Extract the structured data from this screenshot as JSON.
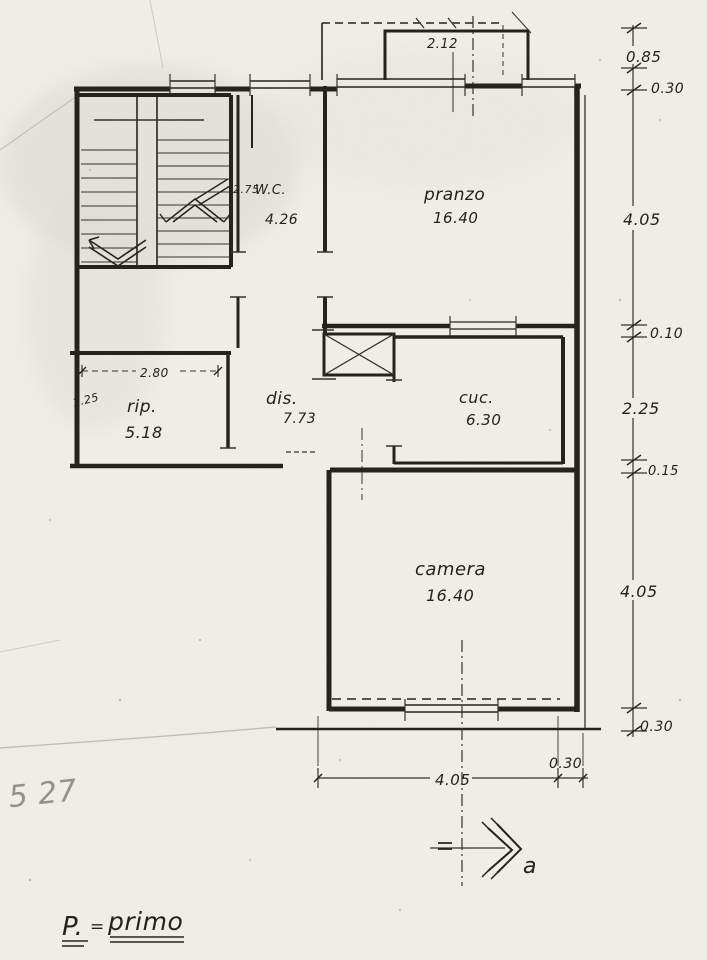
{
  "floor_label": {
    "code": "P.",
    "equals": "=",
    "name": "primo"
  },
  "section_marker": {
    "letter": "a"
  },
  "rooms": {
    "wc": {
      "label": "W.C.",
      "area": "4.26"
    },
    "pranzo": {
      "label": "pranzo",
      "area": "16.40"
    },
    "rip": {
      "label": "rip.",
      "area": "5.18"
    },
    "dis": {
      "label": "dis.",
      "area": "7.73"
    },
    "cuc": {
      "label": "cuc.",
      "area": "6.30"
    },
    "camera": {
      "label": "camera",
      "area": "16.40"
    }
  },
  "dimensions": {
    "balcony_width": "2.12",
    "wc_width": "2.75",
    "rip_width": "2.80",
    "rip_depth": "1.25",
    "right_chain": [
      "0.85",
      "0.30",
      "4.05",
      "0.10",
      "2.25",
      "0.15",
      "4.05",
      "0.30"
    ],
    "bottom_width": "4.05",
    "bottom_side": "0.30"
  },
  "colors": {
    "ink": "#26231f",
    "paper": "#f2efeb"
  }
}
